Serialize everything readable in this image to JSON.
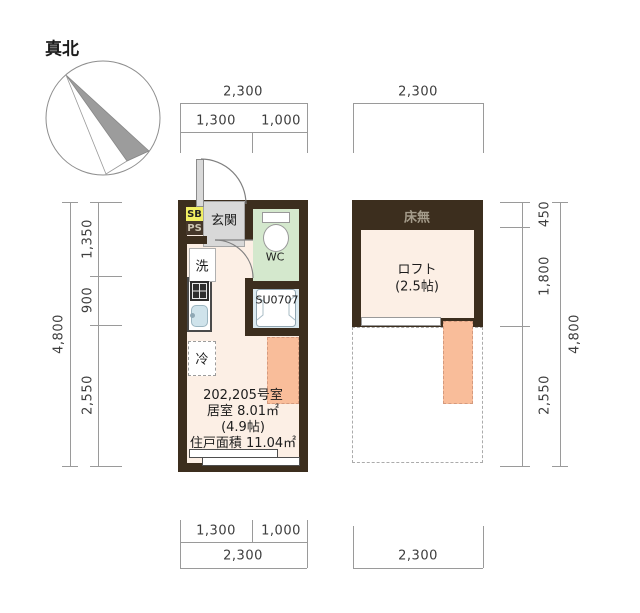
{
  "compass": {
    "label": "真北"
  },
  "unit_plan": {
    "dims": {
      "top_total": "2,300",
      "top_left": "1,300",
      "top_right": "1,000",
      "left_total": "4,800",
      "left_seg1": "1,350",
      "left_seg2": "900",
      "left_seg3": "2,550",
      "bottom_left": "1,300",
      "bottom_right": "1,000",
      "bottom_total": "2,300"
    },
    "labels": {
      "sb": "SB",
      "ps": "PS",
      "entrance": "玄関",
      "washer": "洗",
      "wc": "WC",
      "unit_bath": "SU0707",
      "fridge": "冷"
    },
    "info": {
      "room_no": "202,205号室",
      "living_area": "居室 8.01㎡",
      "tatami": "(4.9帖)",
      "total_area": "住戸面積 11.04㎡"
    }
  },
  "loft_plan": {
    "dims": {
      "top_total": "2,300",
      "bottom_total": "2,300",
      "right_total": "4,800",
      "right_seg1": "450",
      "right_seg2": "1,800",
      "right_seg3": "2,550"
    },
    "labels": {
      "no_floor": "床無",
      "loft": "ロフト",
      "loft_size": "(2.5帖)"
    }
  },
  "colors": {
    "wall": "#3c2e1e",
    "floor": "#fcefe5",
    "ladder": "#f9bd9a",
    "wc_floor": "#d4e8cd",
    "bath_floor": "#dceaf0",
    "sb_yellow": "#f1ef63",
    "entrance_tile": "#d8d8d8"
  }
}
